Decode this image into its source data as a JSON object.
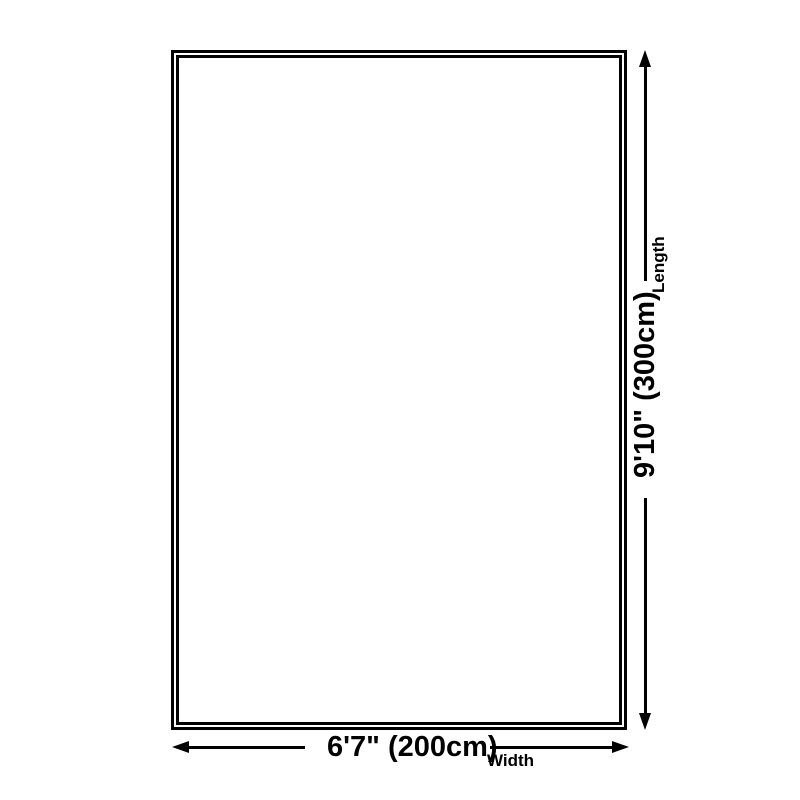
{
  "diagram": {
    "background_color": "#ffffff",
    "line_color": "#000000",
    "outline_border_color": "#000000",
    "text_color": "#000000",
    "width_dimension": {
      "value": "6'7\" (200cm)",
      "label": "Width"
    },
    "length_dimension": {
      "value": "9'10\" (300cm)",
      "label": "Length"
    }
  }
}
